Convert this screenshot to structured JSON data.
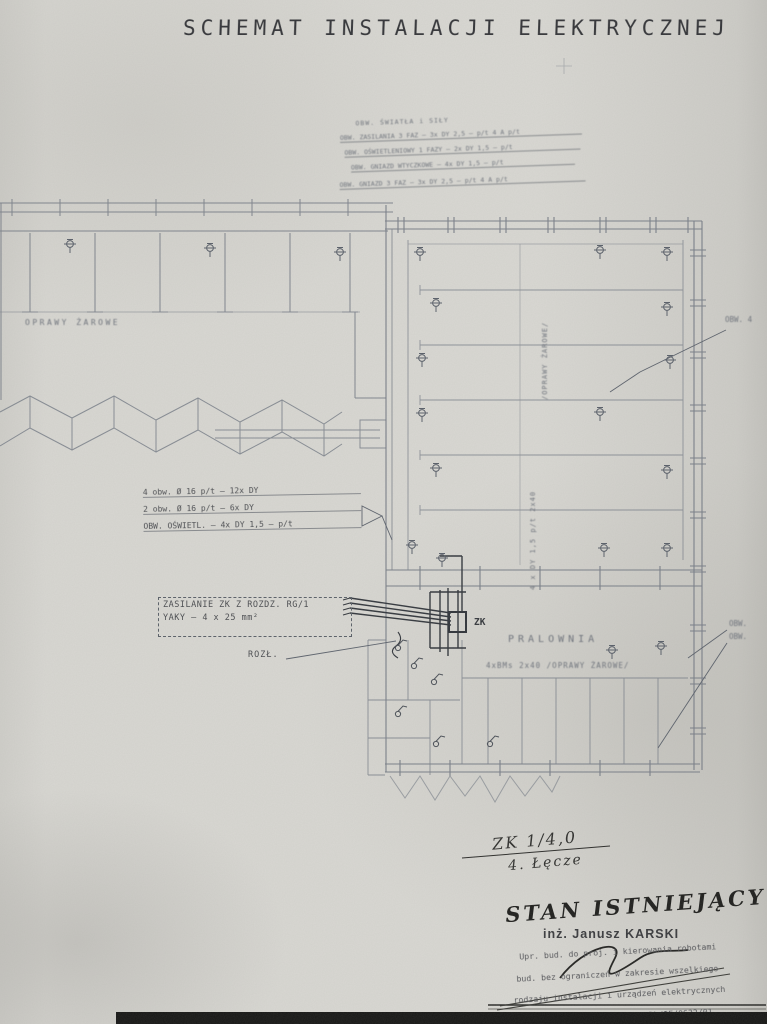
{
  "title": "SCHEMAT INSTALACJI ELEKTRYCZNEJ",
  "legend": {
    "lines": [
      "OBW. ŚWIATŁA i SIŁY",
      "OBW. ZASILANIA 3 FAZ – 3x DY 2,5 – p/t 4 A p/t",
      "OBW. OŚWIETLENIOWY 1 FAZY – 2x DY 1,5 – p/t",
      "OBW. GNIAZD WTYCZKOWE – 4x DY 1,5 – p/t",
      "OBW. GNIAZD 3 FAZ – 3x DY 2,5 – p/t 4 A p/t"
    ]
  },
  "left_wing": {
    "fixtures_label": "OPRAWY ŻAROWE"
  },
  "right_wing": {
    "vertical_label_top": "/OPRAWY ŻAROWE/",
    "vertical_label_mid": "4 x DY 1,5 p/t  2x40",
    "zk_label": "ZK",
    "room_label": "PRALOWNIA",
    "room_sublabel": "4xBMs  2x40  /OPRAWY ŻAROWE/"
  },
  "annotations": {
    "feeder_lines": [
      "4 obw. Ø 16 p/t – 12x DY",
      "2 obw. Ø 16 p/t – 6x DY",
      "OBW. OŚWIETL. – 4x DY 1,5 – p/t"
    ],
    "supply_line1": "ZASILANIE ZK Z ROZDZ. RG/1",
    "supply_line2": "YAKY – 4 x 25 mm²",
    "rozl_label": "ROZŁ.",
    "obw_right_top": "OBW. 4",
    "obw_right_mid1": "OBW.",
    "obw_right_mid2": "OBW."
  },
  "handwriting": {
    "note_line1": "ZK 1/4,0",
    "note_line2": "4. Łęcze",
    "status": "STAN ISTNIEJĄCY"
  },
  "signature": {
    "name": "inż. Janusz KARSKI",
    "stamp_lines": [
      "Upr. bud. do proj. i kierowania robotami",
      "bud. bez ograniczeń w zakresie wszelkiego",
      "rodzaju instalacji i urządzeń elektrycznych",
      "Nr upr. 8U/424/74, POUD Nr PDL/IE/0632/01"
    ]
  },
  "colors": {
    "paper": "#d8d7d2",
    "ink": "#3c3e42",
    "line": "#757b85"
  }
}
